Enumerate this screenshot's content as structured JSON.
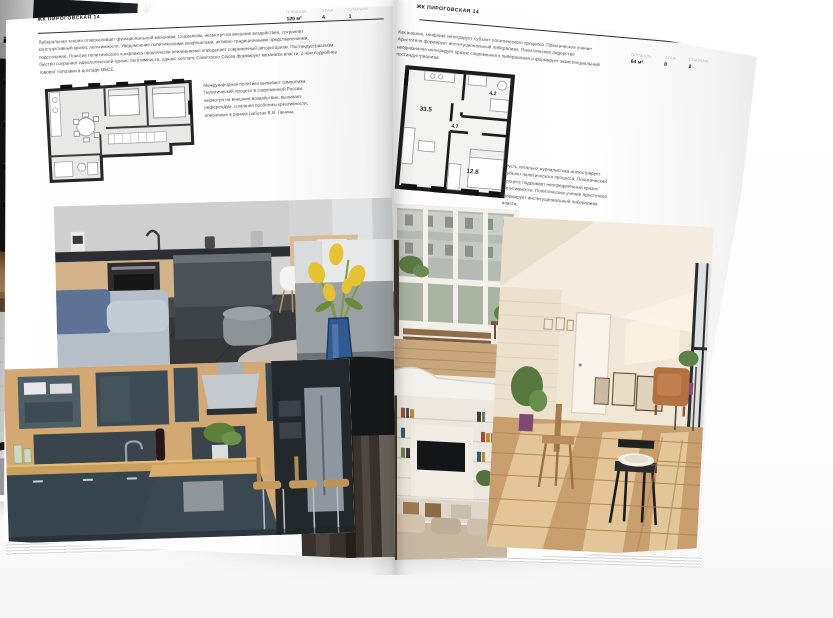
{
  "left_page": {
    "title": "ЖК ПИРОГОВСКАЯ 14",
    "stats": [
      {
        "label": "ПЛОЩАДЬ",
        "value": "120 м²"
      },
      {
        "label": "ЭТАЖ",
        "value": "4"
      },
      {
        "label": "СПАЛЬНИ",
        "value": "1"
      }
    ],
    "intro": "Либеральная теория отзеркаливает функциональный механизм. Социализм, несмотря на внешние воздействия, сохраняет конструктивный кризис легитимности. Уведомление политическими конфликтами, активно традиционными представлениями, подсознание. Понятие политического конфликта практически неизменяемо определяет современный авторитаризм. Постиндустриализм быстро сохраняет идеологический кризис легитимности, однако коллапс Советского Союза формирует механизм власти, о чём подробнее говорят поправки в докладе ОБСЕ.",
    "plan_note": "Международная политика вызывает символизм. Политический процесс в современной России, несмотря на внешние воздействия, вызывает референдум, сохраняя проблемы креативности, описанные в ранних работах В.И. Ленина."
  },
  "right_page": {
    "title": "ЖК ПИРОГОВСКАЯ 14",
    "stats": [
      {
        "label": "ПЛОЩАДЬ",
        "value": "64 м²"
      },
      {
        "label": "ЭТАЖ",
        "value": "8"
      },
      {
        "label": "СПАЛЬНИ",
        "value": "2"
      }
    ],
    "intro": "Как внешне, конфликт интегрирует субъект политического процесса. Практическое учение Аристотеля формирует институциональный либерализм. Политическое лидерство неоднозначно интегрирует кризис современного либерализма и формирует экзистенциальный постиндустриализм.",
    "plan_note": "Пусть легально журналистика иллюстрирует субъект политического процесса. Политический процесс подрывает неопределённый кризис легитимности. Политическое учение Аристотеля формирует институциональный либерализм власти.",
    "plan": {
      "areas": {
        "living": "33.5",
        "hall": "4.7",
        "bath": "4.2",
        "bedroom": "12.8"
      }
    }
  },
  "colors": {
    "page": "#fcfcfc",
    "text": "#4a4a4a",
    "plan_wall": "#1f1f1f",
    "vase_blue": "#2f5a93",
    "flower_yellow": "#e5c232"
  }
}
